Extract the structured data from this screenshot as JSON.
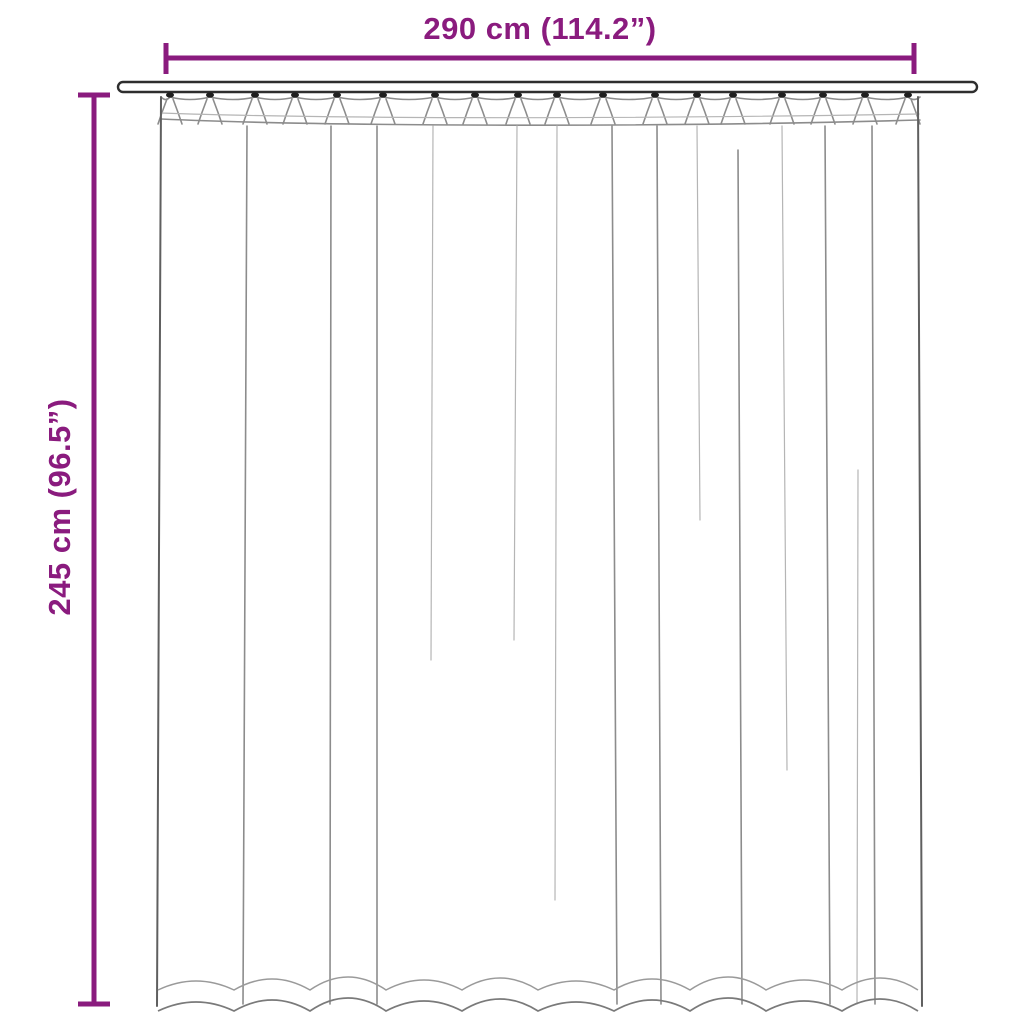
{
  "labels": {
    "width": "290 cm (114.2”)",
    "height": "245 cm (96.5”)"
  },
  "colors": {
    "accent": "#8A1B7E",
    "artwork-line": "#8C8C8C",
    "rod-outline": "#2E2E2E",
    "background": "#FFFFFF"
  }
}
